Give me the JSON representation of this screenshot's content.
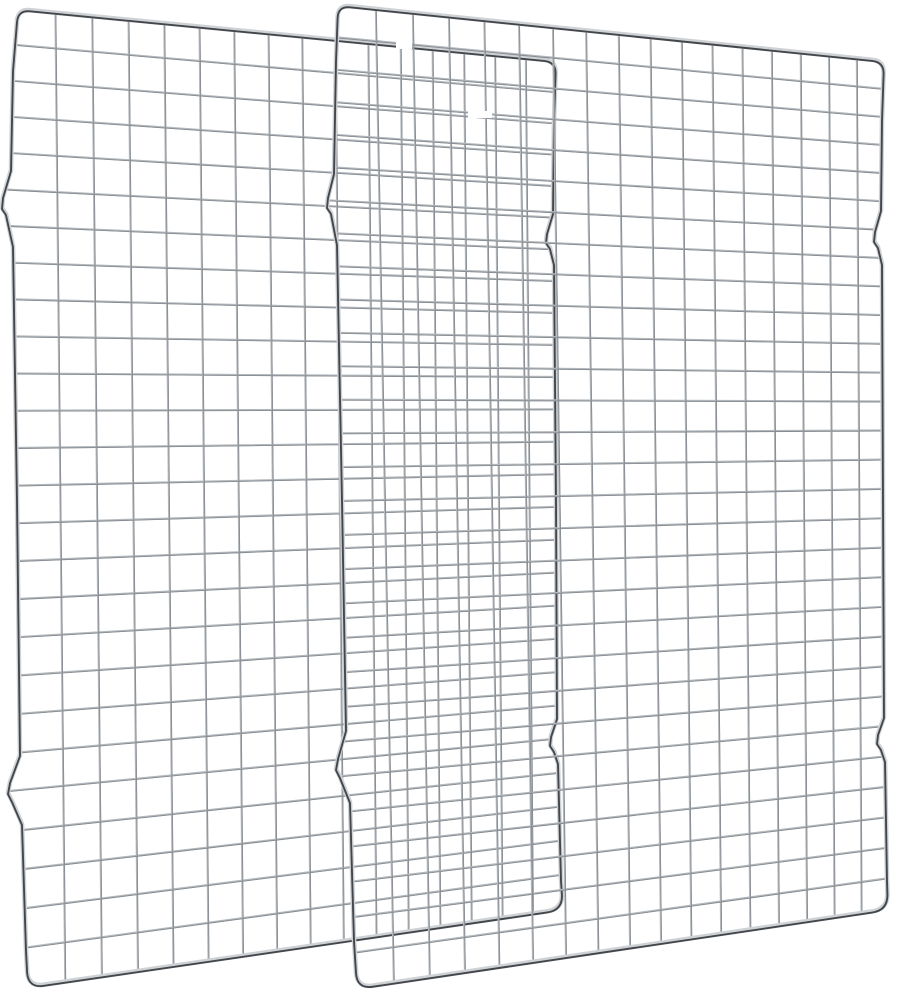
{
  "meta": {
    "type": "product-photo",
    "description": "Two overlapping chrome wire grid cooling racks (2-pack) standing upright on a plain white background",
    "aria_label": "Two stainless steel wire cooling racks overlapping, product image"
  },
  "scene": {
    "background": "#ffffff",
    "canvas": {
      "width": 899,
      "height": 1000
    },
    "styles": {
      "grid_light": "#b3b8bc",
      "grid_dark": "#878c92",
      "grid_width": 2.0,
      "grid_core_width": 0.9,
      "frame_light": "#cfd2d5",
      "frame_dark": "#43474c",
      "frame_width": 4.6,
      "frame_core_width": 1.9,
      "corner_radius_top": 12,
      "corner_radius_bottom": 16
    },
    "racks": [
      {
        "name": "back-rack",
        "tl": [
          18,
          9
        ],
        "tr": [
          556,
          61
        ],
        "br": [
          563,
          909
        ],
        "bl": [
          28,
          987
        ],
        "left_edge": [
          [
            13,
            70
          ],
          [
            11,
            170
          ],
          [
            3,
            197
          ],
          [
            2,
            208
          ],
          [
            6,
            214
          ],
          [
            13,
            246
          ],
          [
            17,
            500
          ],
          [
            20,
            755
          ],
          [
            10,
            782
          ],
          [
            8,
            793
          ],
          [
            12,
            801
          ],
          [
            22,
            824
          ],
          [
            26,
            950
          ]
        ],
        "right_edge": [
          [
            554,
            120
          ],
          [
            553,
            213
          ],
          [
            547,
            233
          ],
          [
            546,
            242
          ],
          [
            550,
            248
          ],
          [
            554,
            264
          ],
          [
            556,
            500
          ],
          [
            557,
            718
          ],
          [
            551,
            736
          ],
          [
            550,
            745
          ],
          [
            554,
            751
          ],
          [
            558,
            763
          ],
          [
            561,
            880
          ]
        ],
        "cols": 16,
        "rows": 26,
        "kx": 0.12,
        "ky": -0.05
      },
      {
        "name": "front-rack",
        "tl": [
          338,
          5
        ],
        "tr": [
          884,
          61
        ],
        "br": [
          888,
          909
        ],
        "bl": [
          357,
          988
        ],
        "left_edge": [
          [
            336,
            60
          ],
          [
            334,
            173
          ],
          [
            328,
            197
          ],
          [
            327,
            207
          ],
          [
            331,
            213
          ],
          [
            337,
            244
          ],
          [
            342,
            500
          ],
          [
            346,
            730
          ],
          [
            338,
            758
          ],
          [
            336,
            769
          ],
          [
            340,
            777
          ],
          [
            350,
            802
          ],
          [
            354,
            940
          ]
        ],
        "right_edge": [
          [
            882,
            120
          ],
          [
            881,
            210
          ],
          [
            875,
            231
          ],
          [
            874,
            241
          ],
          [
            878,
            247
          ],
          [
            882,
            264
          ],
          [
            883,
            500
          ],
          [
            884,
            717
          ],
          [
            878,
            734
          ],
          [
            877,
            743
          ],
          [
            881,
            749
          ],
          [
            885,
            761
          ],
          [
            887,
            880
          ]
        ],
        "cols": 17,
        "rows": 29,
        "kx": 0.19,
        "ky": -0.05
      }
    ],
    "highlight_gaps": [
      {
        "x": 396,
        "y": 40,
        "w": 16,
        "h": 9
      },
      {
        "x": 468,
        "y": 111,
        "w": 24,
        "h": 7
      },
      {
        "x": 783,
        "y": 111,
        "w": 17,
        "h": 7
      }
    ]
  }
}
